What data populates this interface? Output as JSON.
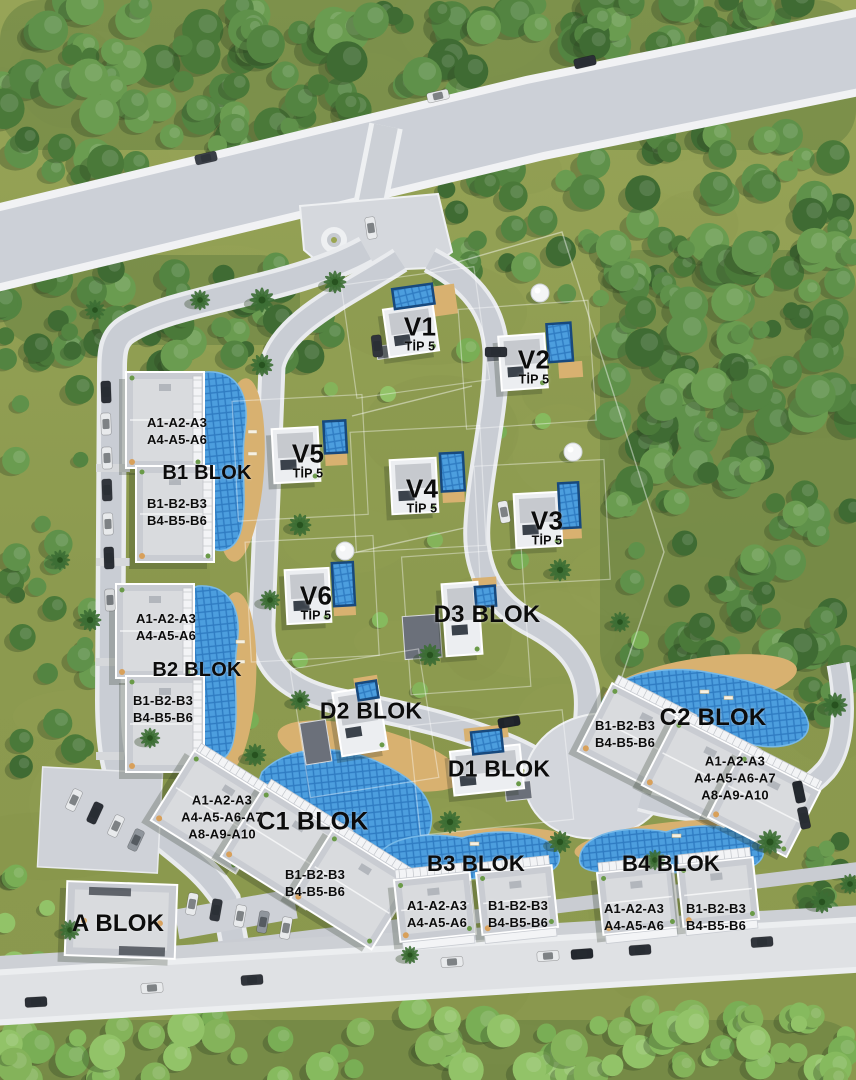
{
  "plan": {
    "villas": [
      {
        "name": "V1",
        "type": "TİP 5",
        "x": 420,
        "y": 333
      },
      {
        "name": "V2",
        "type": "TİP 5",
        "x": 534,
        "y": 366
      },
      {
        "name": "V5",
        "type": "TİP 5",
        "x": 308,
        "y": 460
      },
      {
        "name": "V4",
        "type": "TİP 5",
        "x": 422,
        "y": 495
      },
      {
        "name": "V3",
        "type": "TİP 5",
        "x": 547,
        "y": 527
      },
      {
        "name": "V6",
        "type": "TİP 5",
        "x": 316,
        "y": 602
      }
    ],
    "blocks": [
      {
        "name": "B1 BLOK",
        "x": 207,
        "y": 473
      },
      {
        "name": "B2 BLOK",
        "x": 197,
        "y": 670
      },
      {
        "name": "D3 BLOK",
        "x": 487,
        "y": 615
      },
      {
        "name": "D2 BLOK",
        "x": 371,
        "y": 711
      },
      {
        "name": "D1 BLOK",
        "x": 499,
        "y": 769
      },
      {
        "name": "C2 BLOK",
        "x": 713,
        "y": 718
      },
      {
        "name": "C1 BLOK",
        "x": 313,
        "y": 822
      },
      {
        "name": "B3 BLOK",
        "x": 476,
        "y": 864
      },
      {
        "name": "B4 BLOK",
        "x": 671,
        "y": 864
      },
      {
        "name": "A BLOK",
        "x": 118,
        "y": 924
      }
    ],
    "units": [
      {
        "lines": [
          "A1-A2-A3",
          "A4-A5-A6"
        ],
        "x": 177,
        "y": 431
      },
      {
        "lines": [
          "B1-B2-B3",
          "B4-B5-B6"
        ],
        "x": 177,
        "y": 512
      },
      {
        "lines": [
          "A1-A2-A3",
          "A4-A5-A6"
        ],
        "x": 166,
        "y": 627
      },
      {
        "lines": [
          "B1-B2-B3",
          "B4-B5-B6"
        ],
        "x": 163,
        "y": 709
      },
      {
        "lines": [
          "B1-B2-B3",
          "B4-B5-B6"
        ],
        "x": 625,
        "y": 734
      },
      {
        "lines": [
          "A1-A2-A3",
          "A4-A5-A6-A7",
          "A8-A9-A10"
        ],
        "x": 735,
        "y": 778
      },
      {
        "lines": [
          "A1-A2-A3",
          "A4-A5-A6-A7",
          "A8-A9-A10"
        ],
        "x": 222,
        "y": 817
      },
      {
        "lines": [
          "B1-B2-B3",
          "B4-B5-B6"
        ],
        "x": 315,
        "y": 883
      },
      {
        "lines": [
          "A1-A2-A3",
          "A4-A5-A6"
        ],
        "x": 437,
        "y": 914
      },
      {
        "lines": [
          "B1-B2-B3",
          "B4-B5-B6"
        ],
        "x": 518,
        "y": 914
      },
      {
        "lines": [
          "A1-A2-A3",
          "A4-A5-A6"
        ],
        "x": 634,
        "y": 917
      },
      {
        "lines": [
          "B1-B2-B3",
          "B4-B5-B6"
        ],
        "x": 716,
        "y": 917
      }
    ],
    "colors": {
      "grass": "#8e9b51",
      "forest": "#4a7939",
      "road": "#ccd0d7",
      "road_edge": "#f1f2f4",
      "pool": "#4095da",
      "deck": "#d8b170",
      "roof": "#c9ccd2",
      "label_text": "#0c0c0c"
    }
  }
}
